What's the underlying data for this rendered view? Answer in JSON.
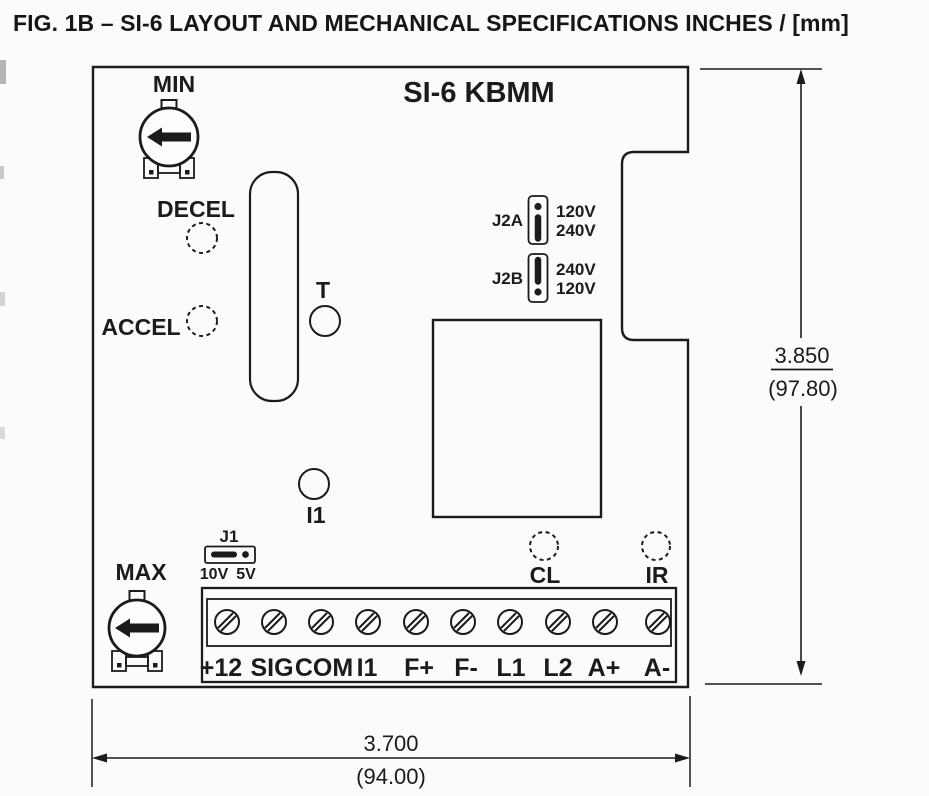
{
  "colors": {
    "ink": "#1b1b1b",
    "paper": "#fbfbf9"
  },
  "figure": {
    "title": "FIG. 1B – SI-6 LAYOUT AND MECHANICAL SPECIFICATIONS INCHES / [mm]"
  },
  "board": {
    "name": "SI-6 KBMM",
    "pot_min_label": "MIN",
    "pot_max_label": "MAX",
    "holes": {
      "decel": "DECEL",
      "accel": "ACCEL",
      "t": "T",
      "i1": "I1",
      "cl": "CL",
      "ir": "IR"
    },
    "jumpers": {
      "j2a": {
        "label": "J2A",
        "top_option": "120V",
        "bottom_option": "240V"
      },
      "j2b": {
        "label": "J2B",
        "top_option": "240V",
        "bottom_option": "120V"
      },
      "j1": {
        "label": "J1",
        "left_option": "10V",
        "right_option": "5V"
      }
    },
    "terminals": [
      "+12",
      "SIG",
      "COM",
      "I1",
      "F+",
      "F-",
      "L1",
      "L2",
      "A+",
      "A-"
    ]
  },
  "dimensions": {
    "height_inches": "3.850",
    "height_mm": "(97.80)",
    "width_inches": "3.700",
    "width_mm": "(94.00)"
  }
}
